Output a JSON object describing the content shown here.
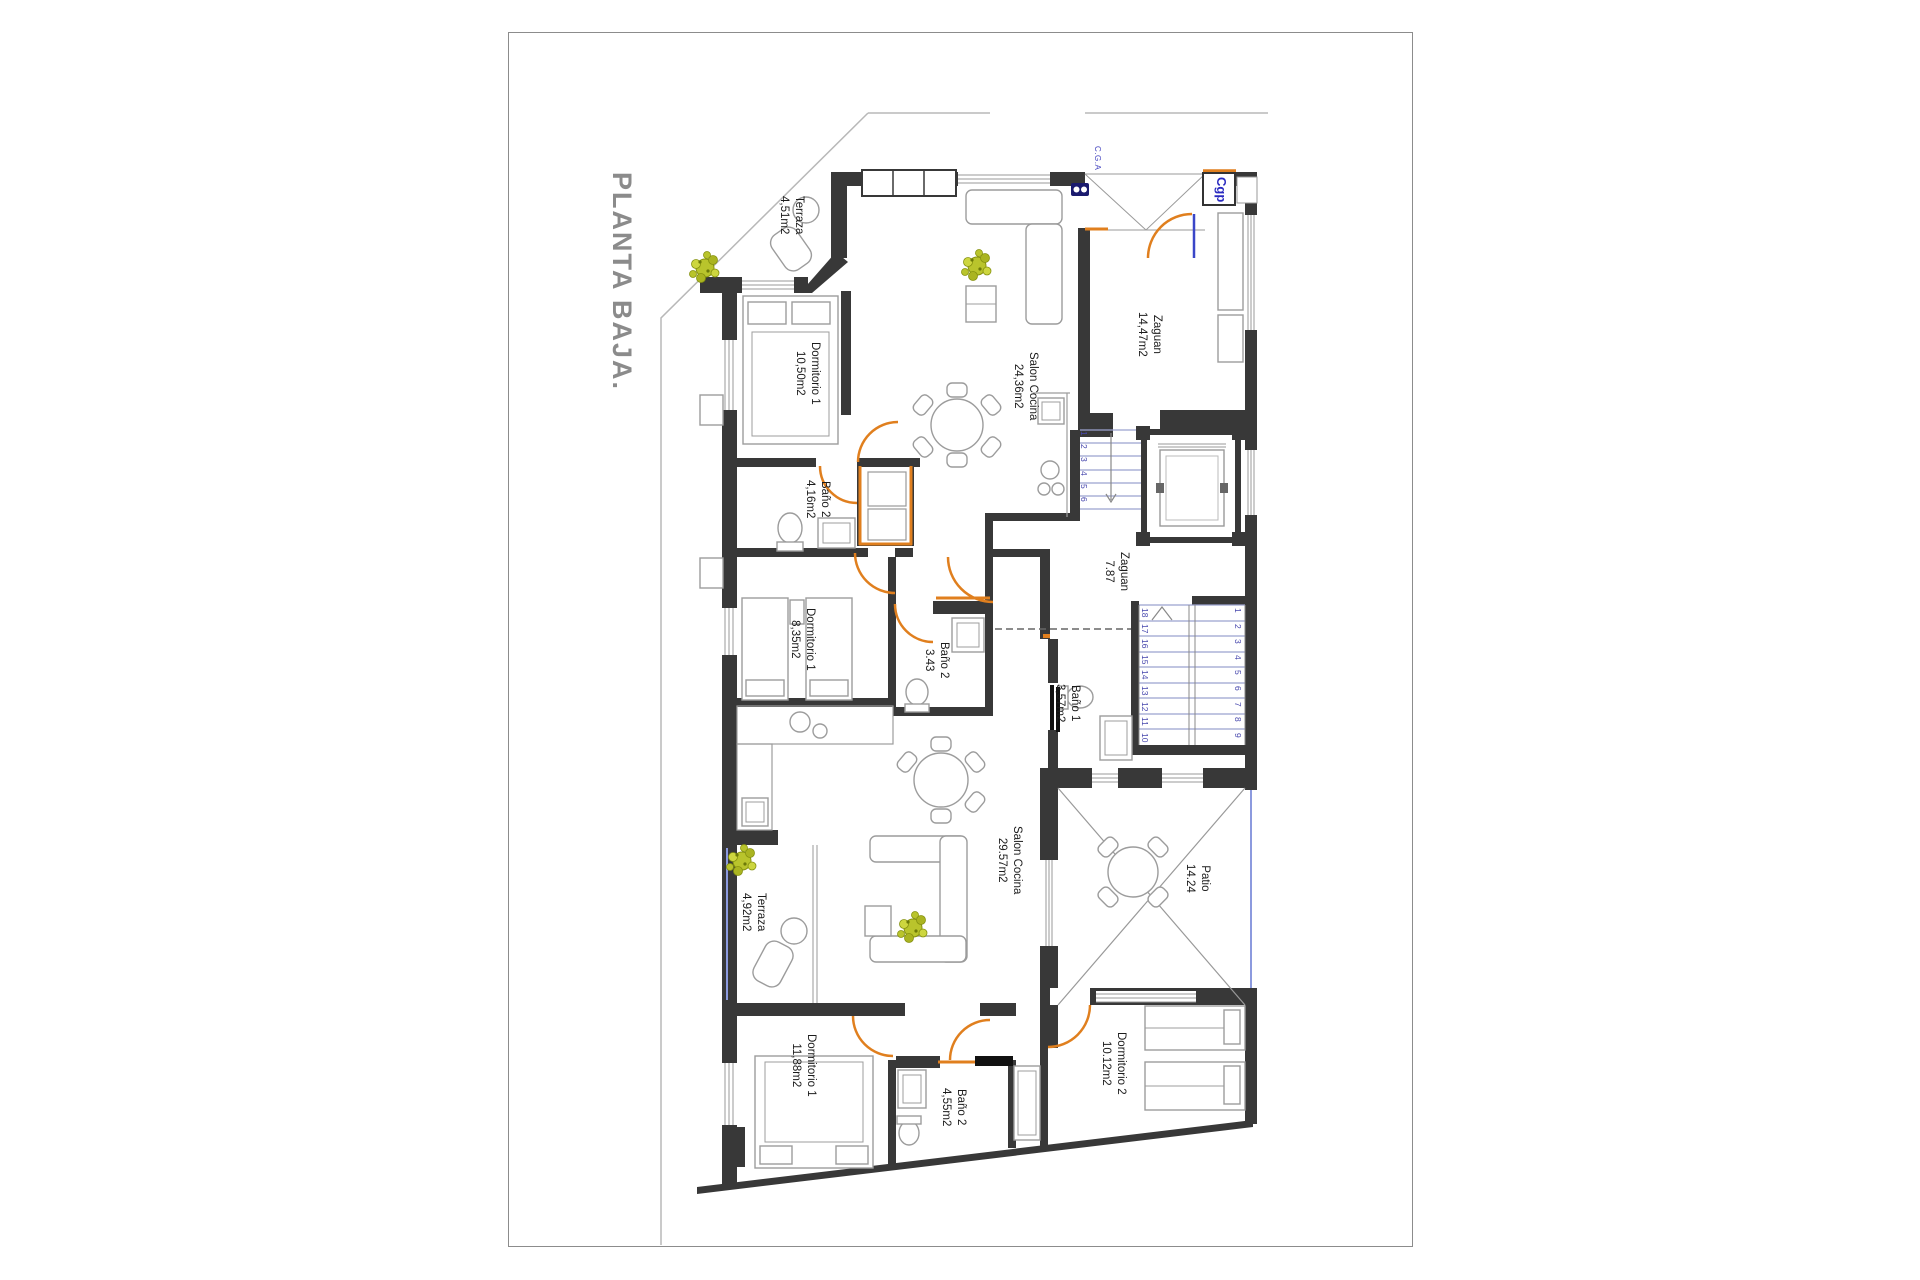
{
  "title": "PLANTA BAJA.",
  "labels": {
    "cga": "C.G.A",
    "cgp": "Cgp"
  },
  "rooms": [
    {
      "name": "Terraza",
      "area": "4,51m2"
    },
    {
      "name": "Dormitorio 1",
      "area": "10,50m2"
    },
    {
      "name": "Salon Cocina",
      "area": "24,36m2"
    },
    {
      "name": "Zaguan",
      "area": "14,47m2"
    },
    {
      "name": "Baño 2",
      "area": "4,16m2"
    },
    {
      "name": "Dormitorio 1",
      "area": "8,35m2"
    },
    {
      "name": "Baño 2",
      "area": "3.43"
    },
    {
      "name": "Zaguan",
      "area": "7.87"
    },
    {
      "name": "Baño 1",
      "area": "3,57m2"
    },
    {
      "name": "Salon Cocina",
      "area": "29.57m2"
    },
    {
      "name": "Patio",
      "area": "14.24"
    },
    {
      "name": "Terraza",
      "area": "4,92m2"
    },
    {
      "name": "Dormitorio 1",
      "area": "11,88m2"
    },
    {
      "name": "Baño 2",
      "area": "4,55m2"
    },
    {
      "name": "Dormitorio 2",
      "area": "10.12m2"
    }
  ],
  "stairs": {
    "upper_flight": [
      "1",
      "2",
      "3",
      "4",
      "5",
      "6"
    ],
    "main_left": [
      "18",
      "17",
      "16",
      "15",
      "14",
      "13",
      "12",
      "11",
      "10"
    ],
    "main_right": [
      "1",
      "2",
      "3",
      "4",
      "5",
      "6",
      "7",
      "8",
      "9"
    ]
  },
  "colors": {
    "wall": "#383838",
    "door": "#e07f1e",
    "stair": "#9aa2cf",
    "stair_number": "#4747ad",
    "accent_blue": "#3a46c8",
    "window_blue": "#8c9ade",
    "plant": "#b9c42c",
    "title": "#8b8b8b"
  }
}
